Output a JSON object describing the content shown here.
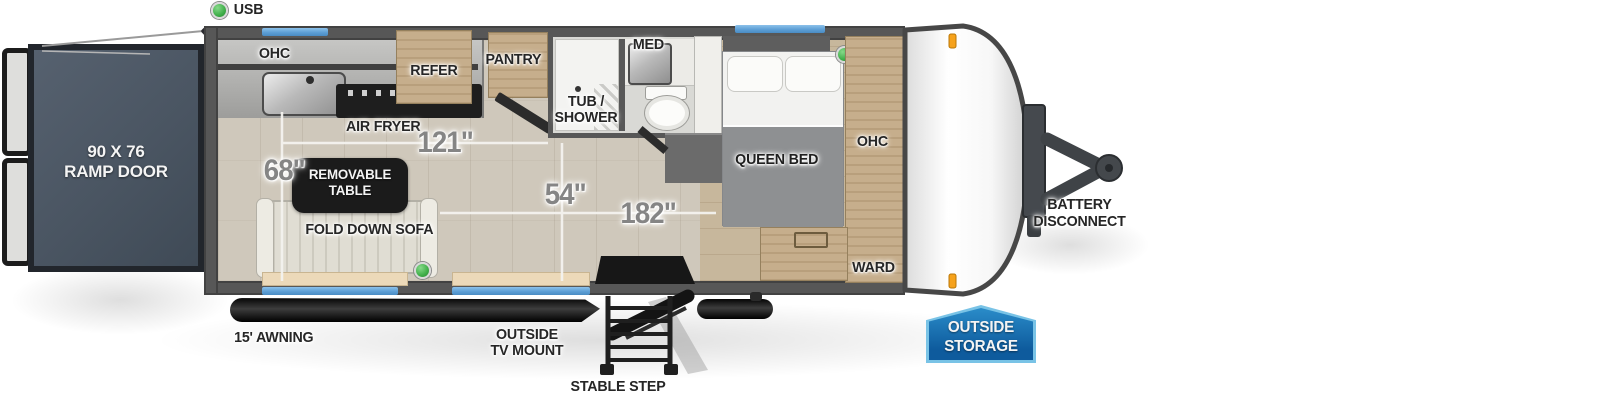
{
  "diagram": {
    "type": "travel-trailer floorplan",
    "legend_usb": "USB",
    "ramp_door": {
      "line1": "90 X 76",
      "line2": "RAMP DOOR"
    },
    "kitchen": {
      "ohc": "OHC",
      "air_fryer": "AIR FRYER",
      "refer": "REFER",
      "pantry": "PANTRY"
    },
    "bathroom": {
      "med": "MED",
      "tub_line1": "TUB /",
      "tub_line2": "SHOWER"
    },
    "bedroom": {
      "queen_bed": "QUEEN BED",
      "ohc": "OHC",
      "ward": "WARD"
    },
    "living": {
      "table_line1": "REMOVABLE",
      "table_line2": "TABLE",
      "sofa": "FOLD DOWN SOFA"
    },
    "dims": {
      "d121": "121\"",
      "d68": "68\"",
      "d54": "54\"",
      "d182": "182\""
    },
    "exterior": {
      "awning": "15' AWNING",
      "tv_line1": "OUTSIDE",
      "tv_line2": "TV MOUNT",
      "step": "STABLE STEP",
      "battery_line1": "BATTERY",
      "battery_line2": "DISCONNECT",
      "storage_line1": "OUTSIDE",
      "storage_line2": "STORAGE"
    },
    "colors": {
      "window_blue": "#5d9fd6",
      "badge_blue": "#1173b4",
      "badge_border": "#79c3e6",
      "usb_green": "#3fae49",
      "clearance_orange": "#f6a21c"
    }
  }
}
